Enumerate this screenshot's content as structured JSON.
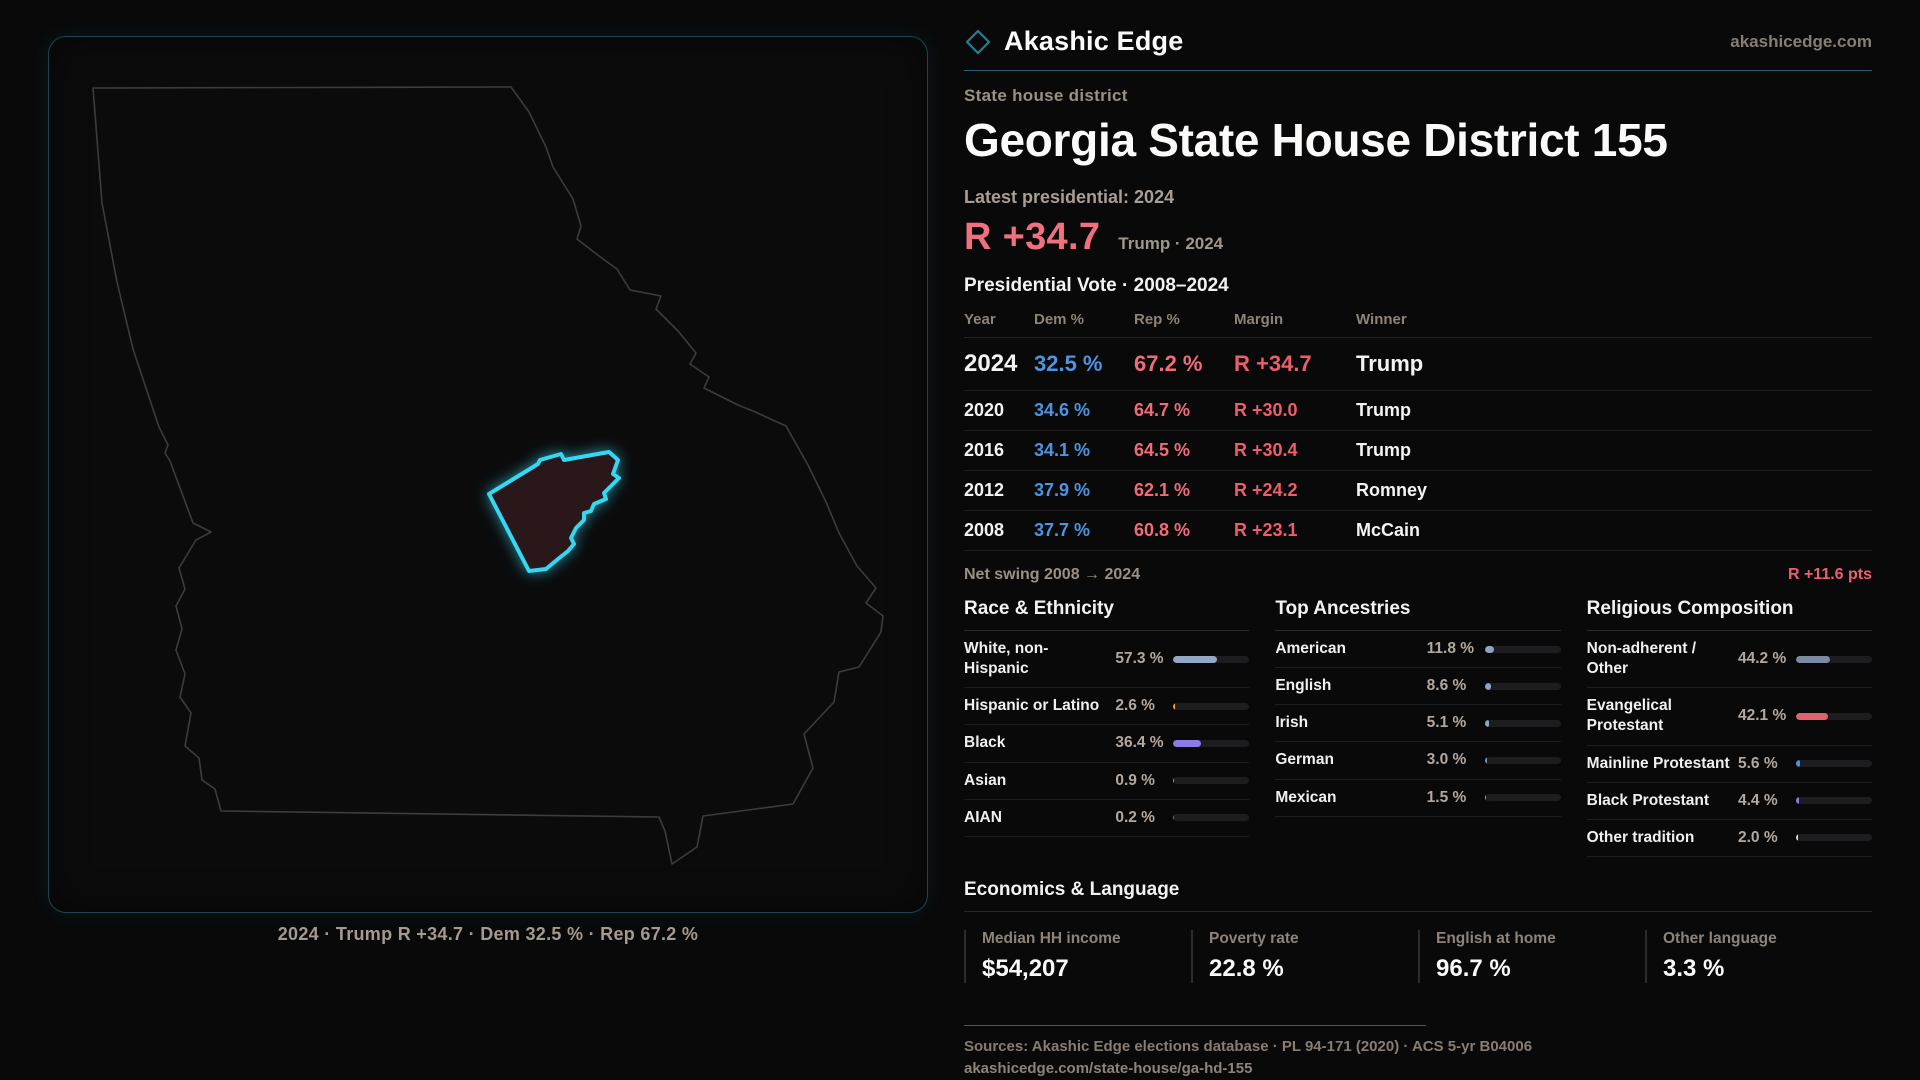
{
  "brand": {
    "name": "Akashic Edge",
    "domain": "akashicedge.com"
  },
  "page": {
    "kicker": "State house district",
    "title": "Georgia State House District 155",
    "latest_label": "Latest presidential: 2024",
    "headline_margin": "R +34.7",
    "headline_sub": "Trump · 2024",
    "table_title": "Presidential Vote · 2008–2024"
  },
  "vote_table": {
    "columns": [
      "Year",
      "Dem %",
      "Rep %",
      "Margin",
      "Winner"
    ],
    "rows": [
      {
        "year": "2024",
        "dem": "32.5 %",
        "rep": "67.2 %",
        "margin": "R +34.7",
        "winner": "Trump"
      },
      {
        "year": "2020",
        "dem": "34.6 %",
        "rep": "64.7 %",
        "margin": "R +30.0",
        "winner": "Trump"
      },
      {
        "year": "2016",
        "dem": "34.1 %",
        "rep": "64.5 %",
        "margin": "R +30.4",
        "winner": "Trump"
      },
      {
        "year": "2012",
        "dem": "37.9 %",
        "rep": "62.1 %",
        "margin": "R +24.2",
        "winner": "Romney"
      },
      {
        "year": "2008",
        "dem": "37.7 %",
        "rep": "60.8 %",
        "margin": "R +23.1",
        "winner": "McCain"
      }
    ]
  },
  "net_swing": {
    "label": "Net swing 2008 → 2024",
    "value": "R +11.6 pts"
  },
  "demographics": {
    "race": {
      "title": "Race & Ethnicity",
      "rows": [
        {
          "label": "White, non-Hispanic",
          "value": "57.3 %",
          "pct": 57.3,
          "color": "#93a8c4"
        },
        {
          "label": "Hispanic or Latino",
          "value": "2.6 %",
          "pct": 2.6,
          "color": "#eda23b"
        },
        {
          "label": "Black",
          "value": "36.4 %",
          "pct": 36.4,
          "color": "#8b7ae6"
        },
        {
          "label": "Asian",
          "value": "0.9 %",
          "pct": 0.9,
          "color": "#42c796"
        },
        {
          "label": "AIAN",
          "value": "0.2 %",
          "pct": 0.2,
          "color": "#6b6b70"
        }
      ]
    },
    "ancestries": {
      "title": "Top Ancestries",
      "rows": [
        {
          "label": "American",
          "value": "11.8 %",
          "pct": 11.8,
          "color": "#8fa6c2"
        },
        {
          "label": "English",
          "value": "8.6 %",
          "pct": 8.6,
          "color": "#8fa6c2"
        },
        {
          "label": "Irish",
          "value": "5.1 %",
          "pct": 5.1,
          "color": "#8fa6c2"
        },
        {
          "label": "German",
          "value": "3.0 %",
          "pct": 3.0,
          "color": "#7d93b5"
        },
        {
          "label": "Mexican",
          "value": "1.5 %",
          "pct": 1.5,
          "color": "#eda23b"
        }
      ]
    },
    "religion": {
      "title": "Religious Composition",
      "rows": [
        {
          "label": "Non-adherent / Other",
          "value": "44.2 %",
          "pct": 44.2,
          "color": "#7d8aa3"
        },
        {
          "label": "Evangelical Protestant",
          "value": "42.1 %",
          "pct": 42.1,
          "color": "#e0626e"
        },
        {
          "label": "Mainline Protestant",
          "value": "5.6 %",
          "pct": 5.6,
          "color": "#4a90e2"
        },
        {
          "label": "Black Protestant",
          "value": "4.4 %",
          "pct": 4.4,
          "color": "#8b7ae6"
        },
        {
          "label": "Other tradition",
          "value": "2.0 %",
          "pct": 2.0,
          "color": "#d8d8d8"
        }
      ]
    }
  },
  "economics": {
    "title": "Economics & Language",
    "stats": [
      {
        "label": "Median HH income",
        "value": "$54,207"
      },
      {
        "label": "Poverty rate",
        "value": "22.8 %"
      },
      {
        "label": "English at home",
        "value": "96.7 %"
      },
      {
        "label": "Other language",
        "value": "3.3 %"
      }
    ]
  },
  "map": {
    "caption": "2024 · Trump  R +34.7 · Dem 32.5 % · Rep 67.2 %"
  },
  "footer": {
    "sources": "Sources: Akashic Edge elections database · PL 94-171 (2020) · ACS 5-yr B04006",
    "link": "akashicedge.com/state-house/ga-hd-155"
  },
  "colors": {
    "accent_cyan": "#35d7f3",
    "dem_blue": "#4f94e0",
    "rep_red": "#ee6d79",
    "margin_red": "#ed5d6b",
    "panel_border": "#1c4550"
  }
}
